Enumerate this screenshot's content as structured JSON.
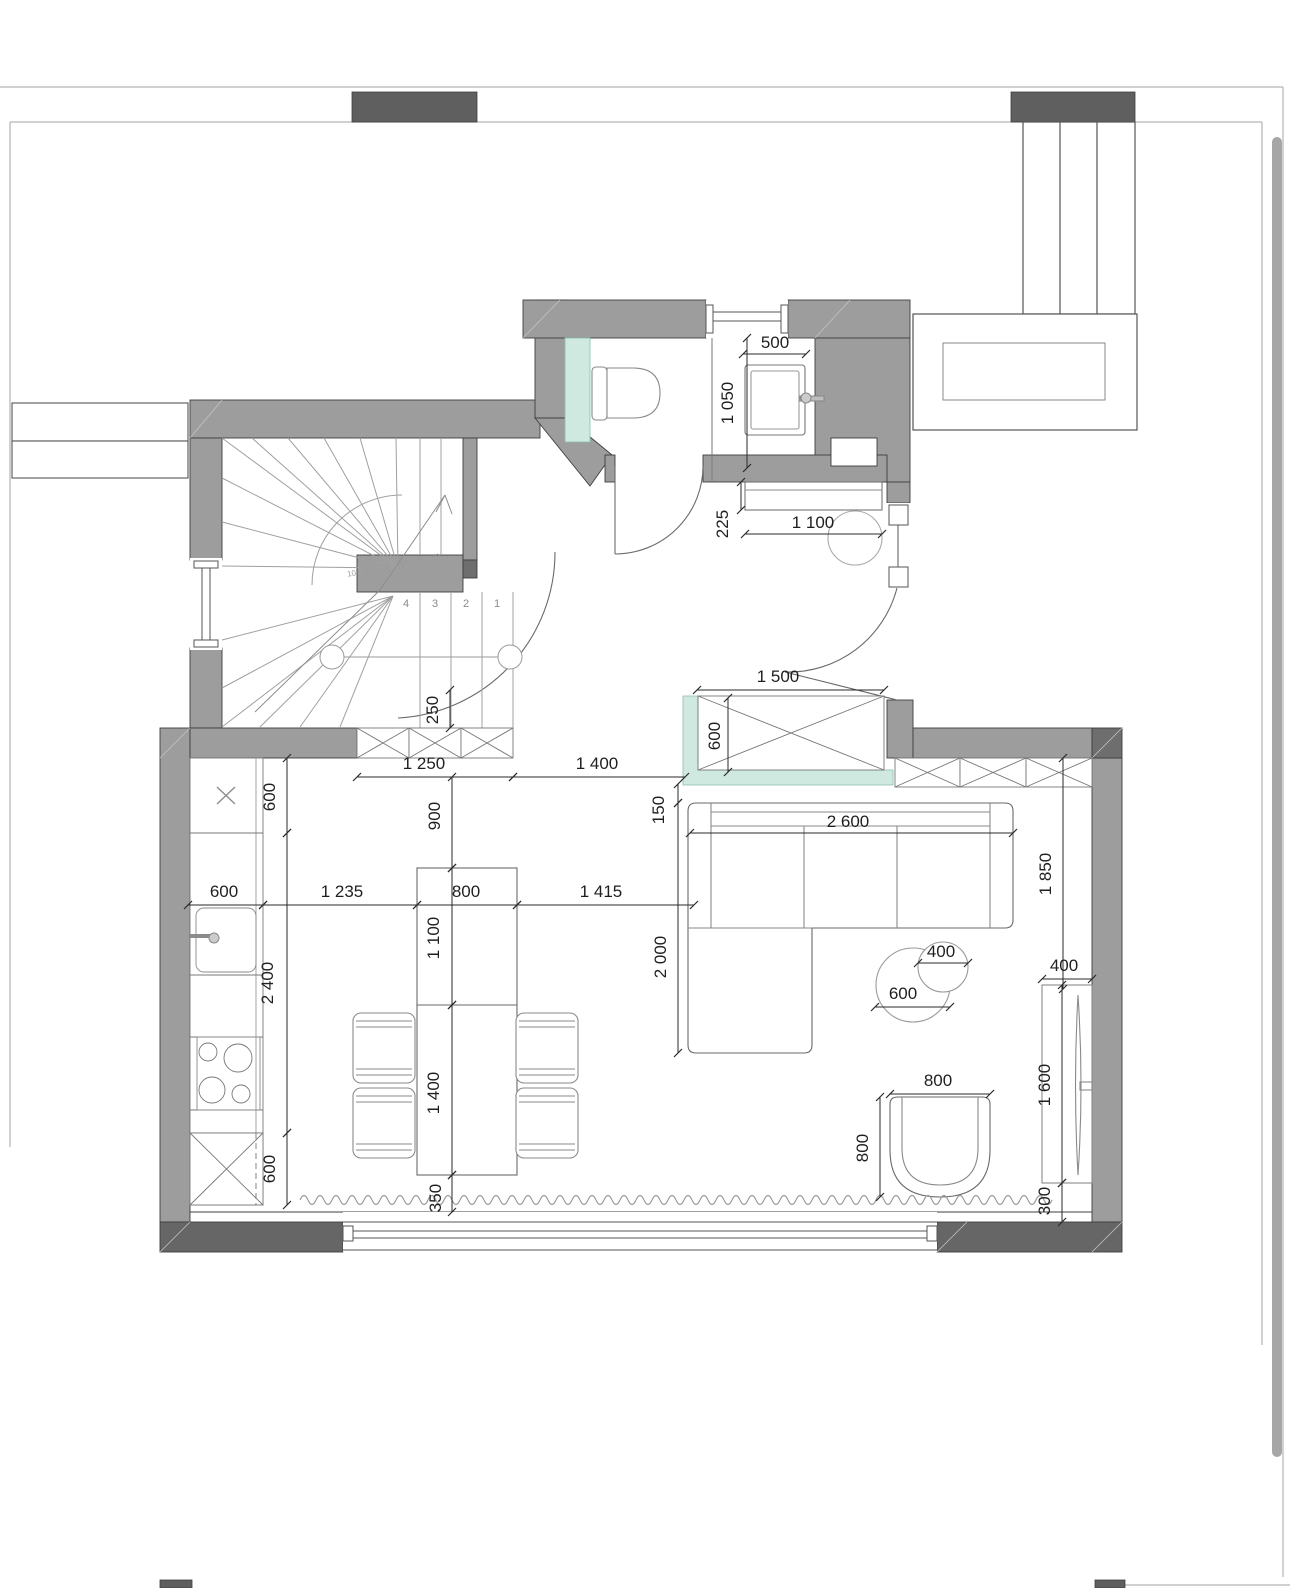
{
  "colors": {
    "wall_gray": "#9d9d9d",
    "wall_dark": "#666666",
    "accent_dark": "#5f5f5f",
    "mint_green": "#cfe8e0",
    "line": "#3f3f3f",
    "furniture_line": "#6a6a6a",
    "stair_line": "#a0a0a0",
    "scrollbar": "#a6a6a6"
  },
  "dims": [
    {
      "value": "500",
      "lx": 775,
      "ly": 348,
      "rot": 0,
      "x1": 743,
      "y1": 354,
      "x2": 806,
      "y2": 354
    },
    {
      "value": "1 050",
      "lx": 733,
      "ly": 403,
      "rot": -90,
      "x1": 747,
      "y1": 338,
      "x2": 747,
      "y2": 468
    },
    {
      "value": "225",
      "lx": 728,
      "ly": 524,
      "rot": -90,
      "x1": 741,
      "y1": 482,
      "x2": 741,
      "y2": 510
    },
    {
      "value": "1 100",
      "lx": 813,
      "ly": 528,
      "rot": 0,
      "x1": 745,
      "y1": 534,
      "x2": 882,
      "y2": 534
    },
    {
      "value": "1 500",
      "lx": 778,
      "ly": 682,
      "rot": 0,
      "x1": 697,
      "y1": 690,
      "x2": 884,
      "y2": 690
    },
    {
      "value": "600",
      "lx": 720,
      "ly": 736,
      "rot": -90,
      "x1": 728,
      "y1": 698,
      "x2": 728,
      "y2": 772
    },
    {
      "value": "250",
      "lx": 438,
      "ly": 710,
      "rot": -90,
      "x1": 450,
      "y1": 690,
      "x2": 450,
      "y2": 728
    },
    {
      "value": "1 250",
      "lx": 424,
      "ly": 769,
      "rot": 0,
      "x1": 357,
      "y1": 777,
      "x2": 513,
      "y2": 777
    },
    {
      "value": "1 400",
      "lx": 597,
      "ly": 769,
      "rot": 0,
      "x1": 513,
      "y1": 777,
      "x2": 685,
      "y2": 777
    },
    {
      "value": "900",
      "lx": 440,
      "ly": 816,
      "rot": -90,
      "x1": 452,
      "y1": 777,
      "x2": 452,
      "y2": 868
    },
    {
      "value": "150",
      "lx": 664,
      "ly": 810,
      "rot": -90,
      "x1": 678,
      "y1": 784,
      "x2": 678,
      "y2": 803
    },
    {
      "value": "2 600",
      "lx": 848,
      "ly": 827,
      "rot": 0,
      "x1": 690,
      "y1": 833,
      "x2": 1013,
      "y2": 833
    },
    {
      "value": "1 850",
      "lx": 1051,
      "ly": 874,
      "rot": -90,
      "x1": 1063,
      "y1": 758,
      "x2": 1063,
      "y2": 989
    },
    {
      "value": "600",
      "lx": 275,
      "ly": 797,
      "rot": -90,
      "x1": 287,
      "y1": 758,
      "x2": 287,
      "y2": 833
    },
    {
      "value": "600",
      "lx": 224,
      "ly": 897,
      "rot": 0,
      "x1": 188,
      "y1": 905,
      "x2": 263,
      "y2": 905
    },
    {
      "value": "1 235",
      "lx": 342,
      "ly": 897,
      "rot": 0,
      "x1": 263,
      "y1": 905,
      "x2": 417,
      "y2": 905
    },
    {
      "value": "800",
      "lx": 466,
      "ly": 897,
      "rot": 0,
      "x1": 417,
      "y1": 905,
      "x2": 517,
      "y2": 905
    },
    {
      "value": "1 415",
      "lx": 601,
      "ly": 897,
      "rot": 0,
      "x1": 517,
      "y1": 905,
      "x2": 694,
      "y2": 905
    },
    {
      "value": "2 400",
      "lx": 273,
      "ly": 983,
      "rot": -90,
      "x1": 287,
      "y1": 833,
      "x2": 287,
      "y2": 1133
    },
    {
      "value": "1 100",
      "lx": 439,
      "ly": 938,
      "rot": -90,
      "x1": 452,
      "y1": 868,
      "x2": 452,
      "y2": 1005
    },
    {
      "value": "2 000",
      "lx": 666,
      "ly": 957,
      "rot": -90,
      "x1": 678,
      "y1": 803,
      "x2": 678,
      "y2": 1053
    },
    {
      "value": "400",
      "lx": 941,
      "ly": 957,
      "rot": 0,
      "x1": 918,
      "y1": 963,
      "x2": 968,
      "y2": 963
    },
    {
      "value": "600",
      "lx": 903,
      "ly": 999,
      "rot": 0,
      "x1": 875,
      "y1": 1007,
      "x2": 950,
      "y2": 1007
    },
    {
      "value": "400",
      "lx": 1064,
      "ly": 971,
      "rot": 0,
      "x1": 1042,
      "y1": 979,
      "x2": 1092,
      "y2": 979
    },
    {
      "value": "1 600",
      "lx": 1050,
      "ly": 1085,
      "rot": -90,
      "x1": 1062,
      "y1": 985,
      "x2": 1062,
      "y2": 1183
    },
    {
      "value": "1 400",
      "lx": 439,
      "ly": 1093,
      "rot": -90,
      "x1": 452,
      "y1": 1005,
      "x2": 452,
      "y2": 1175
    },
    {
      "value": "600",
      "lx": 275,
      "ly": 1169,
      "rot": -90,
      "x1": 287,
      "y1": 1133,
      "x2": 287,
      "y2": 1205
    },
    {
      "value": "800",
      "lx": 938,
      "ly": 1086,
      "rot": 0,
      "x1": 890,
      "y1": 1094,
      "x2": 990,
      "y2": 1094
    },
    {
      "value": "800",
      "lx": 868,
      "ly": 1148,
      "rot": -90,
      "x1": 880,
      "y1": 1097,
      "x2": 880,
      "y2": 1197
    },
    {
      "value": "350",
      "lx": 441,
      "ly": 1198,
      "rot": -90,
      "x1": 452,
      "y1": 1175,
      "x2": 452,
      "y2": 1212
    },
    {
      "value": "300",
      "lx": 1050,
      "ly": 1201,
      "rot": -90,
      "x1": 1062,
      "y1": 1183,
      "x2": 1062,
      "y2": 1222
    }
  ],
  "stairs": {
    "steps": [
      {
        "n": "1",
        "x": 497,
        "y": 607,
        "r": 0
      },
      {
        "n": "2",
        "x": 466,
        "y": 607,
        "r": 0
      },
      {
        "n": "3",
        "x": 435,
        "y": 607,
        "r": 0
      },
      {
        "n": "4",
        "x": 406,
        "y": 607,
        "r": 0
      },
      {
        "n": "10",
        "x": 352,
        "y": 576,
        "r": -10
      },
      {
        "n": "11",
        "x": 370,
        "y": 572,
        "r": -25
      },
      {
        "n": "12",
        "x": 388,
        "y": 568,
        "r": -40
      },
      {
        "n": "13",
        "x": 405,
        "y": 564,
        "r": -55
      },
      {
        "n": "14",
        "x": 422,
        "y": 561,
        "r": -70
      },
      {
        "n": "15",
        "x": 439,
        "y": 558,
        "r": -85
      }
    ]
  }
}
